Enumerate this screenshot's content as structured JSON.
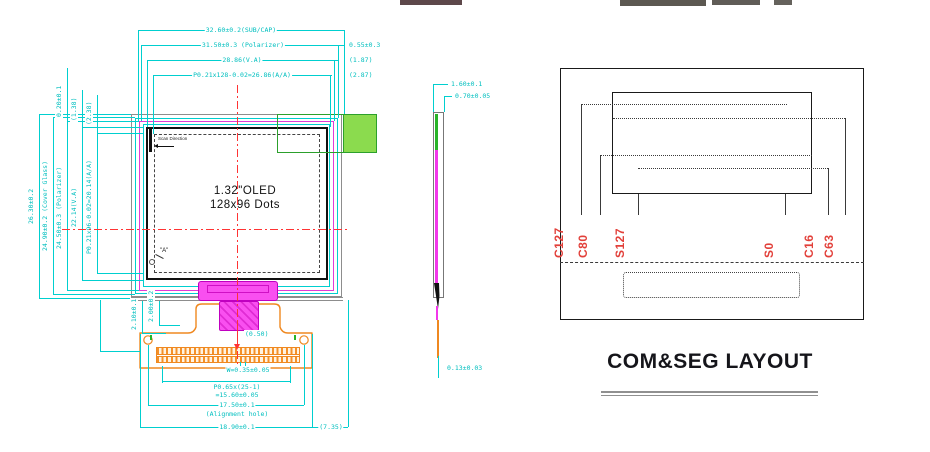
{
  "front": {
    "top_dims": [
      "32.60±0.2(SUB/CAP)",
      "31.50±0.3 (Polarizer)",
      "28.86(V.A)",
      "P0.21x128-0.02=26.86(A/A)"
    ],
    "top_right_dims": [
      "0.55±0.3",
      "(1.87)",
      "(2.87)"
    ],
    "left_dims": [
      "26.30±0.2",
      "24.90±0.2 (Cover Glass)",
      "24.50±0.3 (Polarizer)",
      "22.14(V.A)",
      "P0.21x96-0.02=20.14(A/A)"
    ],
    "left_top_dims": [
      "0.20±0.1",
      "(1.38)",
      "(2.38)"
    ],
    "bottom_left_dims": [
      "2.10±0.1",
      "2.00±0.2"
    ],
    "center_dim": "(0.50)",
    "pin_width": "W=0.35±0.05",
    "pitch_line1": "P0.65x(25-1)",
    "pitch_line2": "=15.60±0.05",
    "hole_span": "17.50±0.1",
    "hole_note": "(Alignment hole)",
    "fpc_width": "18.90±0.1",
    "fpc_right": "(7.35)",
    "scan_direction": "Scan Direction",
    "display_line1": "1.32\"OLED",
    "display_line2": "128x96 Dots",
    "corner_marker": "\"A\""
  },
  "side": {
    "total_thickness": "1.60±0.1",
    "panel_thickness": "0.70±0.05",
    "fpc_thickness": "0.13±0.03"
  },
  "comseg": {
    "title": "COM&SEG LAYOUT",
    "labels": [
      "C127",
      "C80",
      "S127",
      "S0",
      "C16",
      "C63"
    ]
  },
  "colors": {
    "dimension_cyan": "#00cfcf",
    "centerline_red": "#ff3333",
    "polarizer_magenta": "#f237ea",
    "fpc_orange": "#ef8820",
    "highlight_green": "#8bdb4e",
    "com_seg_label_red": "#e2403a"
  }
}
